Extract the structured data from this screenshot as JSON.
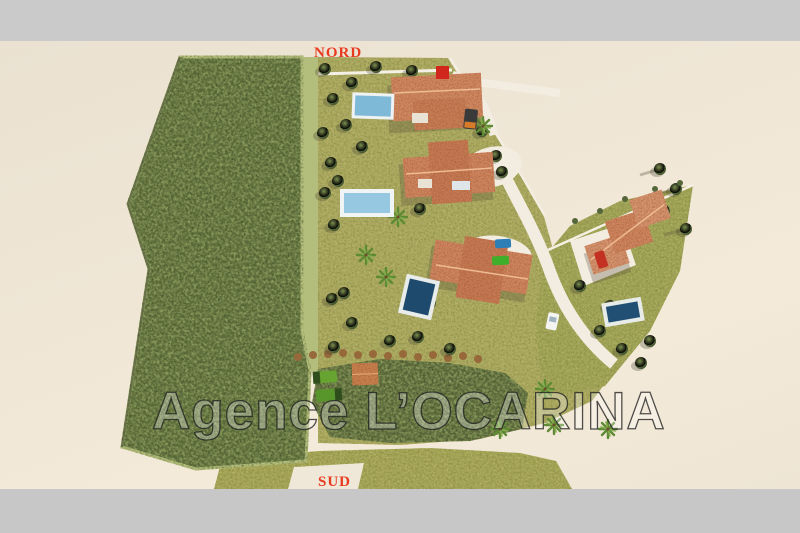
{
  "labels": {
    "north": "NORD",
    "south": "SUD"
  },
  "watermark": {
    "text": "Agence L’OCARINA"
  },
  "scene": {
    "villas": 4,
    "pools": 4,
    "vehicles": 7
  },
  "colors": {
    "letterbox_gray": "#cacaca",
    "terrain_beige": "#efe6d6",
    "forest_green": "#5f6f3c",
    "lawn_olive": "#aaa85f",
    "roof_terracotta": "#d08a62",
    "pool_light_blue": "#8fc3dd",
    "pool_dark_blue": "#214f74",
    "road_light": "#f3ede1",
    "compass_red": "#e73b20",
    "watermark_fill": "rgba(255,255,255,0.30)",
    "watermark_outline": "rgba(30,30,30,0.78)"
  }
}
